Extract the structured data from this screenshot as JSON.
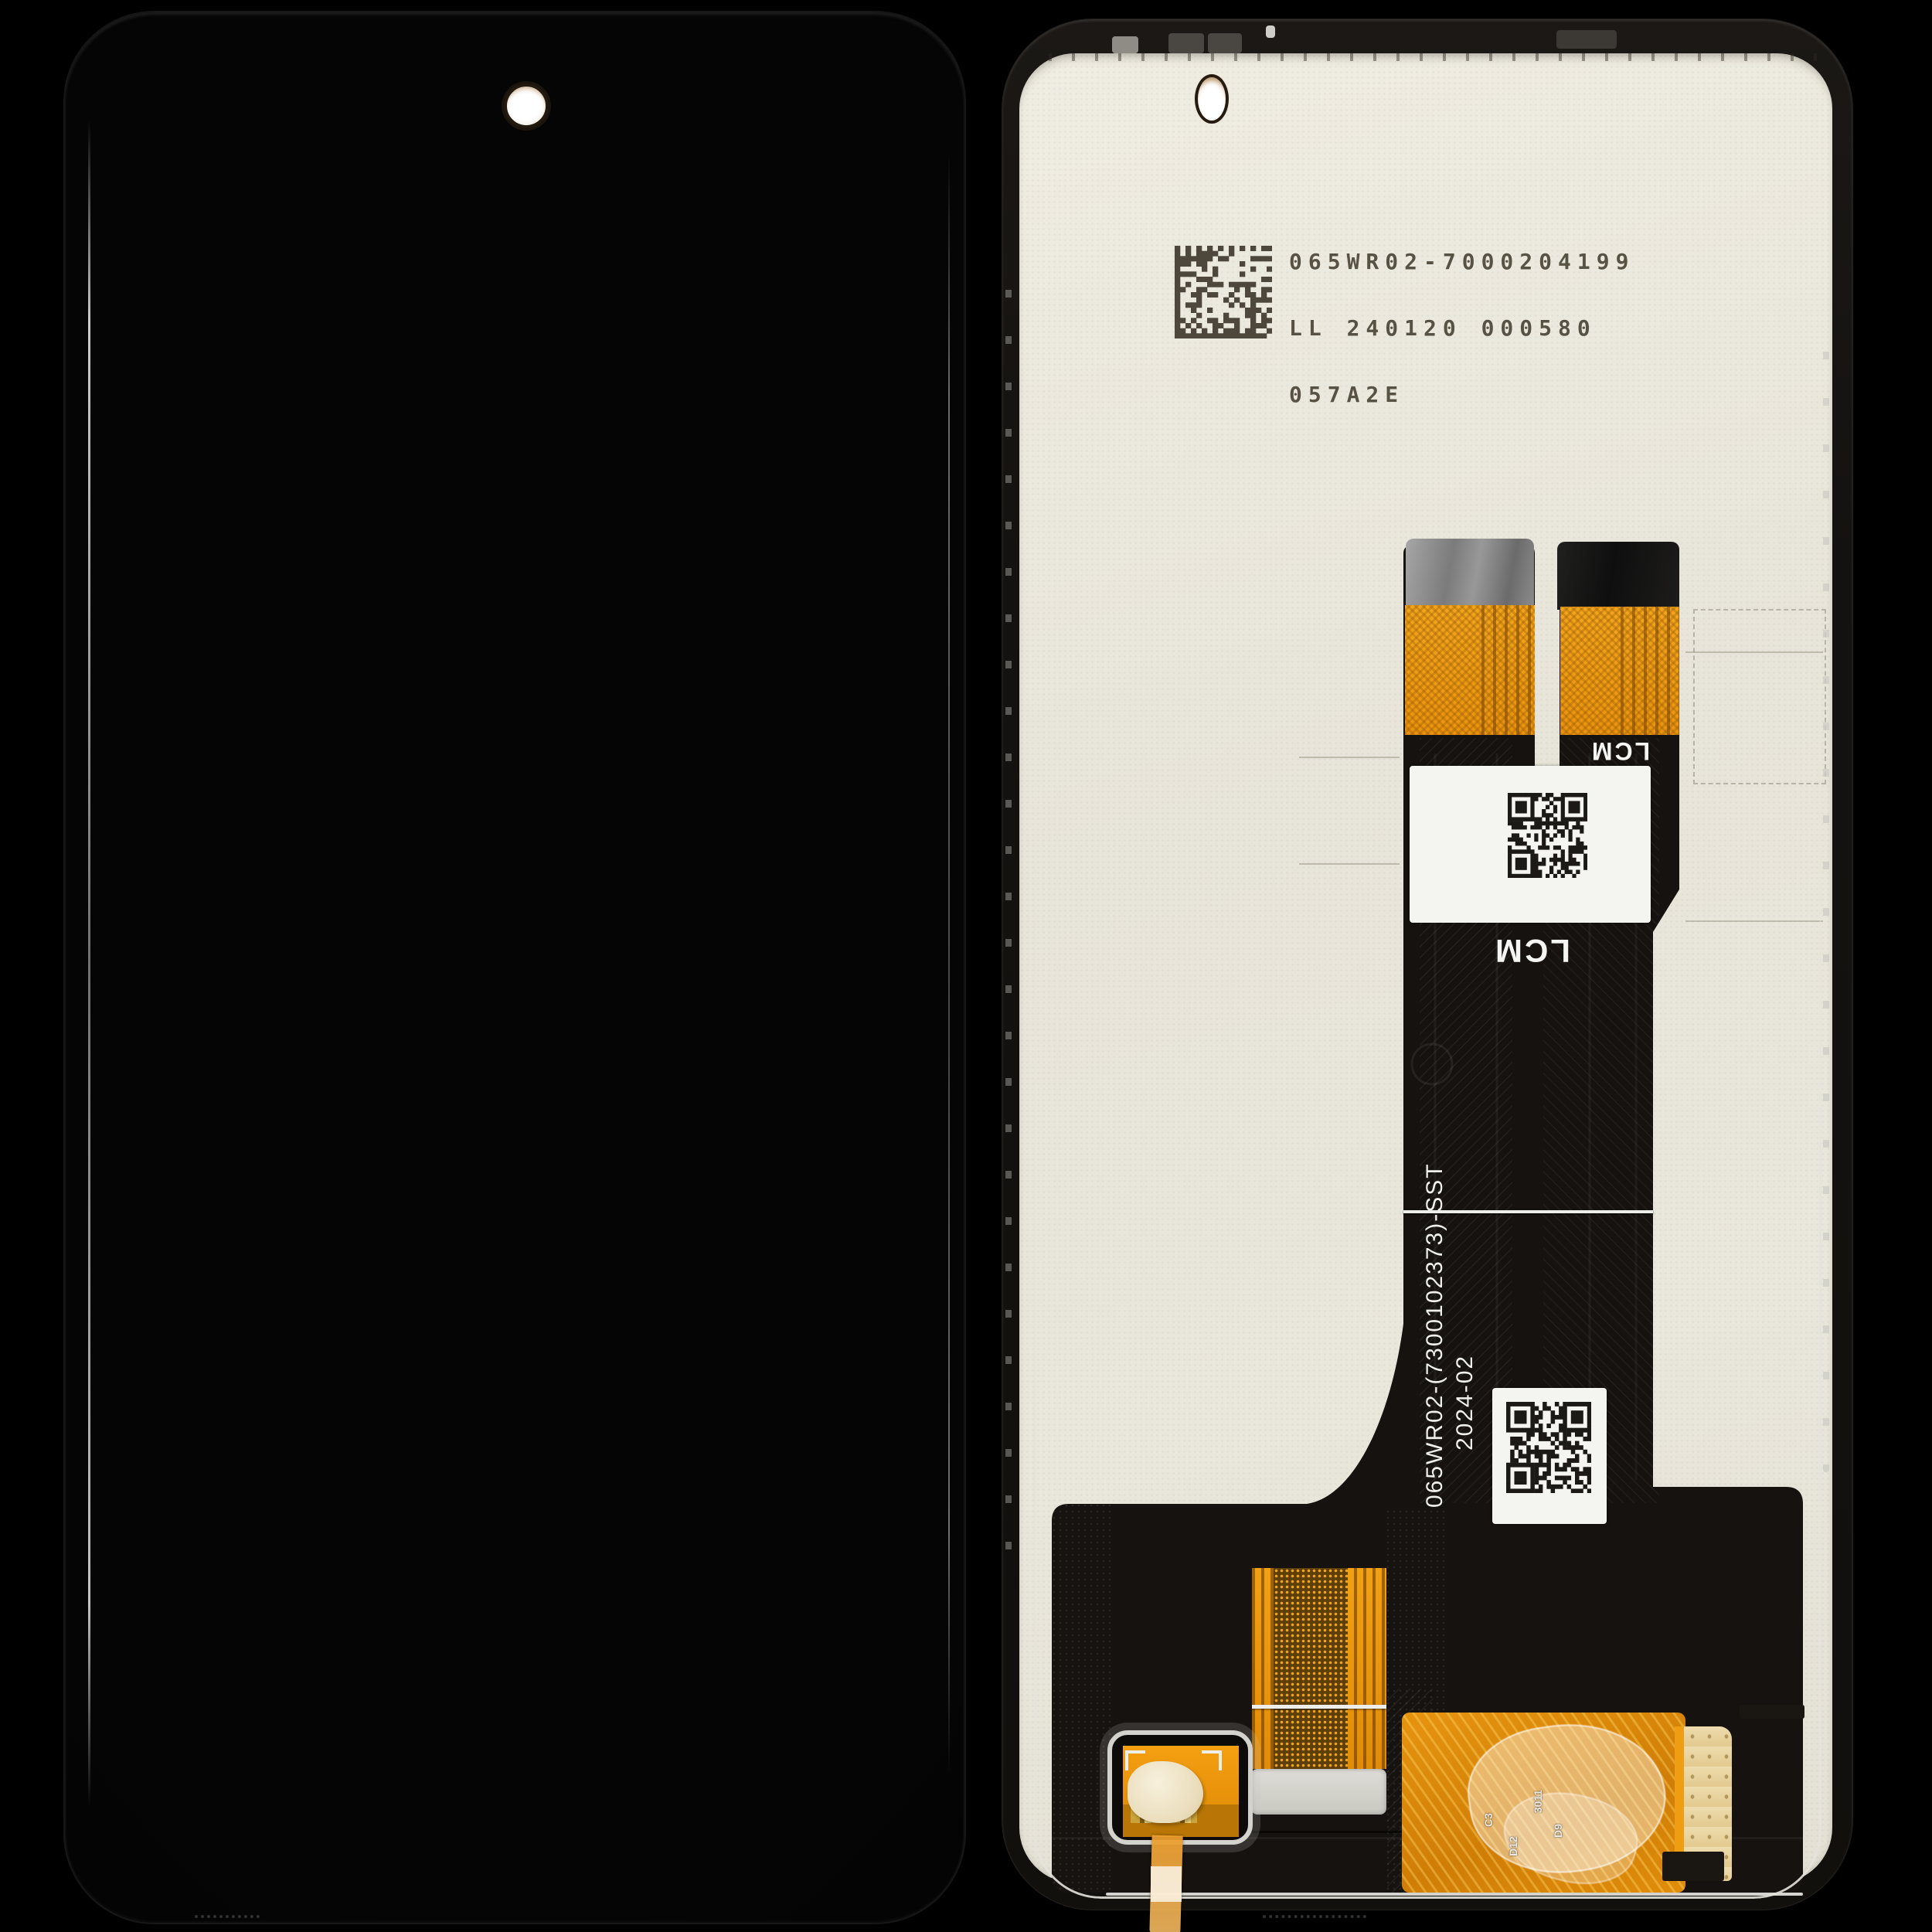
{
  "colors": {
    "background": "#000000",
    "panel_beige": "#e9e6db",
    "flex_orange": "#ef9b16",
    "flex_black": "#16130f",
    "label_white": "#f4f4f1",
    "silver": "#d6d5d0",
    "frame_dark": "#181511"
  },
  "back_panel": {
    "print_label": {
      "line1": "065WR02-7000204199",
      "line2": "LL 240120 000580",
      "line3": "057A2E"
    },
    "flex": {
      "connector_marking_small": "LCM",
      "connector_marking_large": "LCM",
      "part_number_vertical": "065WR02-(7300102373)-SST",
      "date_vertical": "2024-02",
      "pcb_silkscreen": {
        "r1": "C3",
        "r2": "D12",
        "r3": "3011",
        "r4": "D9"
      }
    }
  }
}
